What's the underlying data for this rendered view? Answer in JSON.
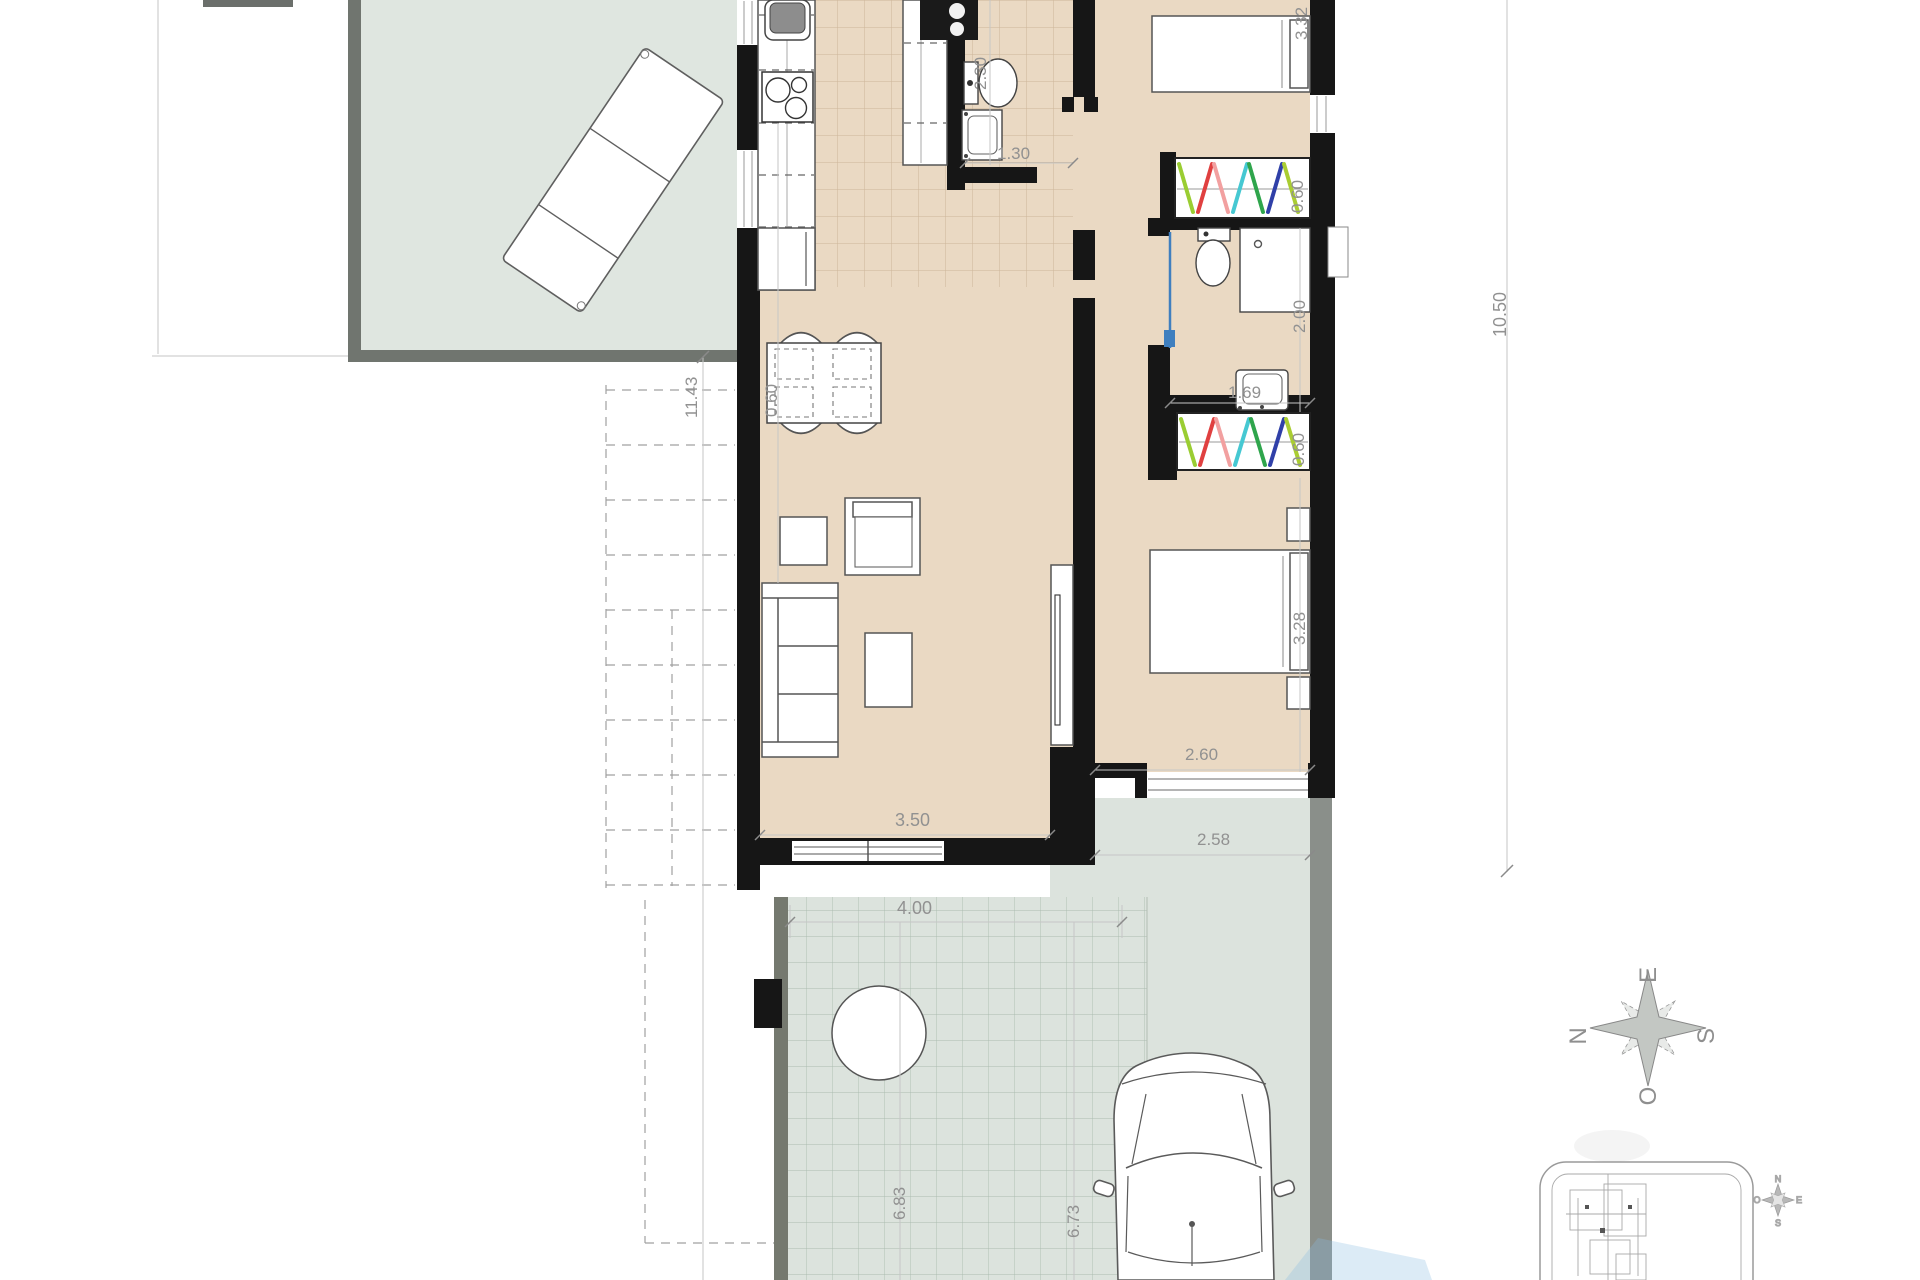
{
  "floor_plan": {
    "dimensions": {
      "terrace_side": "11.43",
      "counter_run": "0.60",
      "wc1_length": "2.30",
      "wc1_width": "1.30",
      "bedroom2_width": "3.32",
      "wardrobe2_depth": "0.60",
      "building_length": "10.50",
      "bath2_length": "2.00",
      "bath2_width": "1.69",
      "wardrobe1_depth": "0.60",
      "bedroom1_length": "3.28",
      "bedroom1_width": "2.60",
      "terrace_right_width": "2.58",
      "living_width": "3.50",
      "patio_width": "4.00",
      "patio_length": "6.83",
      "driveway_length": "6.73"
    },
    "compass": {
      "north": "N",
      "east": "E",
      "south": "S",
      "west": "O"
    },
    "mini_compass": {
      "north": "N",
      "east": "E",
      "south": "S",
      "west": "O"
    },
    "colors": {
      "wall": "#161616",
      "interior_floor": "#ead9c3",
      "terrace_floor": "#dfe6e0",
      "patio_tiles": "#dce3dd",
      "boundary_gray": "#70756f",
      "dimension_text": "#919191",
      "sliding_door": "#3f7fbf",
      "hangers": [
        "#9ACD32",
        "#E04040",
        "#F2A0A0",
        "#46C8D2",
        "#2FA54C",
        "#3040A8",
        "#AACD32"
      ]
    }
  }
}
